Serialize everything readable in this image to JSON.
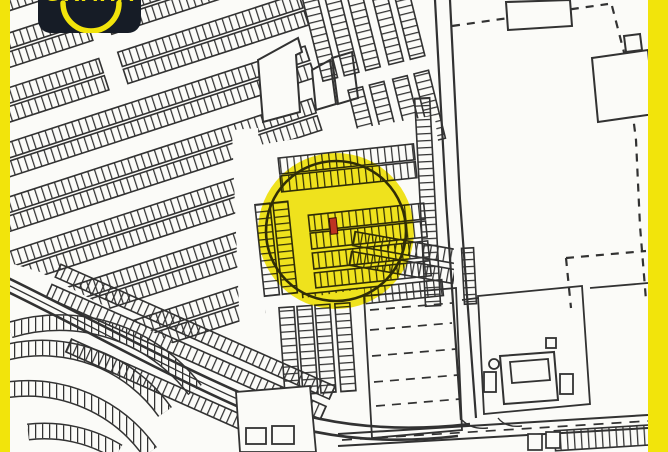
{
  "colors": {
    "yellow": "#F2E40B",
    "logo_bg": "#161C26",
    "map_background": "#FBFBF8",
    "line": "#222222",
    "marker_red": "#BE3322"
  },
  "logo": {
    "brand_text": "GRAHA"
  },
  "map": {
    "highlight_circle": {
      "cx": 336,
      "cy": 231,
      "r": 78,
      "outline_r": 70
    },
    "marker": {
      "x": 330,
      "y": 218,
      "width": 7,
      "height": 16
    }
  },
  "frame": {
    "left_bar_width": 10,
    "right_bar_width": 20
  }
}
